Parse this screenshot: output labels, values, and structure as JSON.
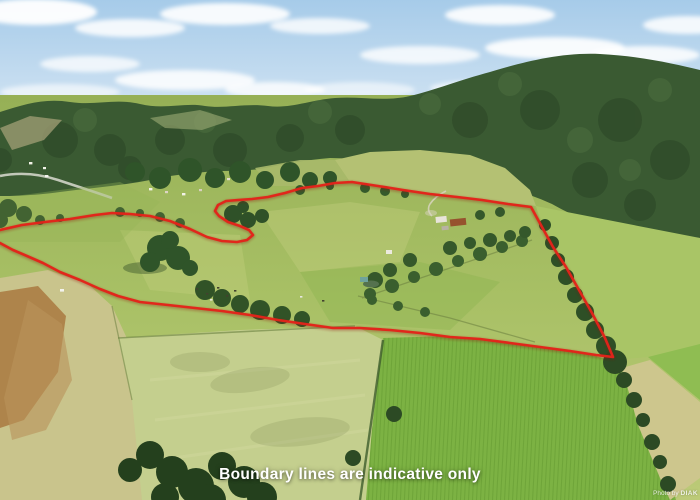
{
  "image": {
    "caption": "Boundary lines are indicative only",
    "watermark": {
      "prefix": "Photo by",
      "brand": "DIAK"
    }
  },
  "boundary": {
    "color": "#e3231a",
    "shadow_color": "#8f130b",
    "stroke_width": 2.6,
    "points": [
      [
        0,
        230
      ],
      [
        22,
        225
      ],
      [
        45,
        222
      ],
      [
        70,
        219
      ],
      [
        95,
        215
      ],
      [
        112,
        213
      ],
      [
        130,
        214
      ],
      [
        150,
        216
      ],
      [
        170,
        221
      ],
      [
        190,
        229
      ],
      [
        207,
        237
      ],
      [
        222,
        241
      ],
      [
        237,
        242
      ],
      [
        247,
        240
      ],
      [
        253,
        235
      ],
      [
        249,
        230
      ],
      [
        240,
        226
      ],
      [
        228,
        222
      ],
      [
        219,
        216
      ],
      [
        215,
        211
      ],
      [
        218,
        205
      ],
      [
        226,
        201
      ],
      [
        238,
        200
      ],
      [
        252,
        199
      ],
      [
        268,
        197
      ],
      [
        285,
        193
      ],
      [
        302,
        188
      ],
      [
        318,
        186
      ],
      [
        335,
        183
      ],
      [
        352,
        182
      ],
      [
        378,
        186
      ],
      [
        403,
        190
      ],
      [
        430,
        194
      ],
      [
        457,
        197
      ],
      [
        482,
        200
      ],
      [
        508,
        204
      ],
      [
        531,
        207
      ],
      [
        542,
        227
      ],
      [
        553,
        247
      ],
      [
        566,
        267
      ],
      [
        579,
        290
      ],
      [
        592,
        313
      ],
      [
        605,
        338
      ],
      [
        613,
        357
      ],
      [
        596,
        355
      ],
      [
        570,
        351
      ],
      [
        540,
        347
      ],
      [
        510,
        343
      ],
      [
        480,
        339
      ],
      [
        450,
        337
      ],
      [
        420,
        333
      ],
      [
        390,
        330
      ],
      [
        360,
        328
      ],
      [
        333,
        328
      ],
      [
        305,
        324
      ],
      [
        278,
        320
      ],
      [
        250,
        315
      ],
      [
        222,
        311
      ],
      [
        195,
        308
      ],
      [
        168,
        305
      ],
      [
        140,
        302
      ],
      [
        118,
        296
      ],
      [
        100,
        289
      ],
      [
        80,
        280
      ],
      [
        60,
        272
      ],
      [
        43,
        263
      ],
      [
        27,
        256
      ],
      [
        13,
        250
      ],
      [
        0,
        243
      ]
    ]
  },
  "palette": {
    "caption_color": "#ffffff",
    "sky_top": "#a6cbe9",
    "sky_bottom": "#dbe9f5",
    "cloud": "#ffffff",
    "far_ridge": "#76905f",
    "forest": "#3a5a32",
    "forest_dark": "#2b4626",
    "pasture": "#a3bd60",
    "pasture_light": "#bcca78",
    "pale_field": "#c4cf8e",
    "dry_field": "#c9c48c",
    "dirt": "#ad8148",
    "maize": "#7cb243",
    "maize_row": "#61982f",
    "hedge": "#2c4a24"
  }
}
